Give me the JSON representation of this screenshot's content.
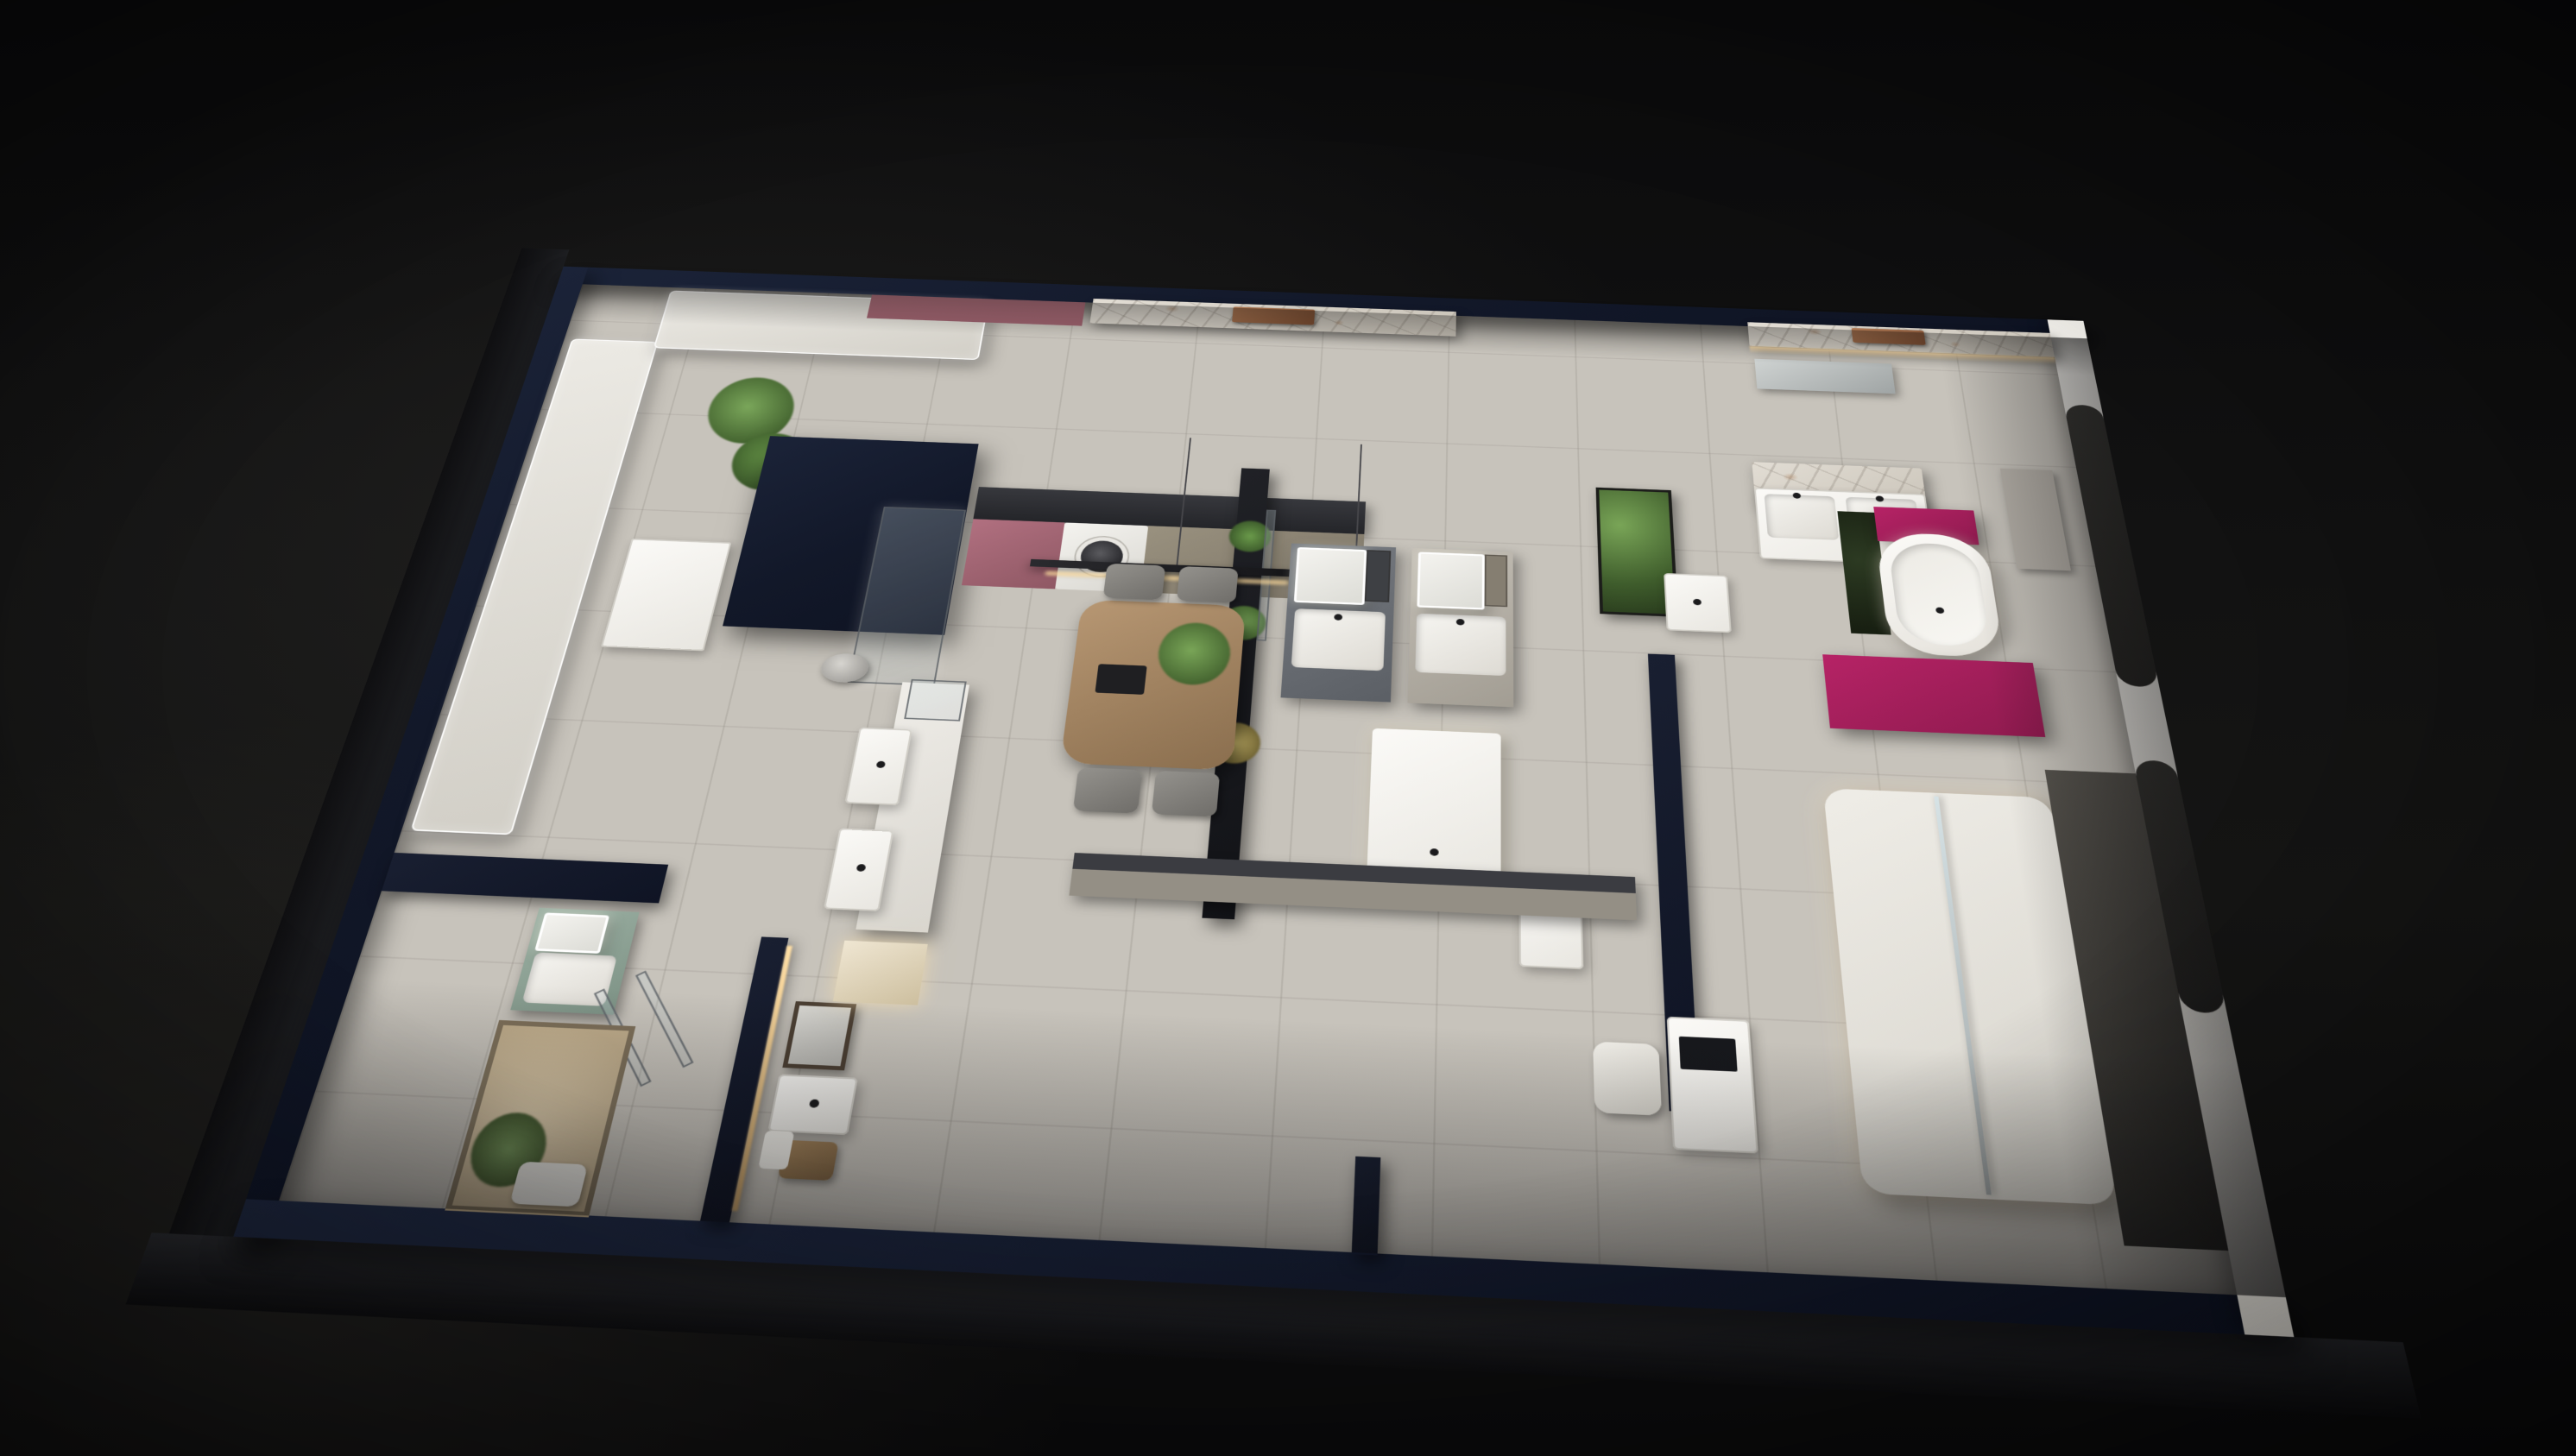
{
  "scene": {
    "type": "3d-floorplan-render",
    "setting": "Isometric night render of a bathroom sanitary-ware showroom",
    "brand": "KIK",
    "brand_plate_north": "KIK",
    "brand_plate_suite": "KIK",
    "desk_logo": "KIK  KIK",
    "palette": {
      "background": "#0d0d0e",
      "outer_wall_navy": "#121829",
      "floor": "#c7c3bb",
      "white_wall": "#d9d6d0",
      "marble_base": "#d9d4cc",
      "copper_plate": "#9a6b4f",
      "magenta_accent": "#a81f5c",
      "pink_cabinet": "#a96a76",
      "taupe_counter": "#8f8779",
      "wood_table": "#ab8e6b",
      "sage_unit": "#93a89b",
      "beige_room": "#d9c8ab",
      "plant_green": "#5d8047",
      "warm_led": "#ffd9a0"
    },
    "counts": {
      "shower_columns_west": 7,
      "shower_columns_north": 3,
      "north_vanity_bays": 4,
      "bottom_vanity_bays": 3,
      "toilet_rows": 5,
      "toilet_columns": 2,
      "chandelier_bulbs": 16,
      "pendant_lamps": 4,
      "dining_chairs": 4,
      "rack_rings": 7,
      "tile_samples": 15
    },
    "regions": [
      {
        "id": "shower-display-wall",
        "label": "Shower fixture display wall with LED-framed panels"
      },
      {
        "id": "kitchen-laundry",
        "label": "Kitchen / laundry display with washing machine"
      },
      {
        "id": "dining-set",
        "label": "Wooden dining table with hanging ring rack"
      },
      {
        "id": "north-vanity-row",
        "label": "Vanity bays along the marble back wall"
      },
      {
        "id": "middle-vanity-room",
        "label": "Central vanity room with display island"
      },
      {
        "id": "bathtub-suite",
        "label": "Freestanding bathtub on magenta podium with bubble chandelier"
      },
      {
        "id": "toilet-gallery",
        "label": "Toilet display platform, 2 columns x 5 rows"
      },
      {
        "id": "southwest-bathrooms",
        "label": "Small bathroom mock-ups and beige lounge"
      },
      {
        "id": "east-arch-wall",
        "label": "White east wall with arched cutouts"
      }
    ]
  }
}
